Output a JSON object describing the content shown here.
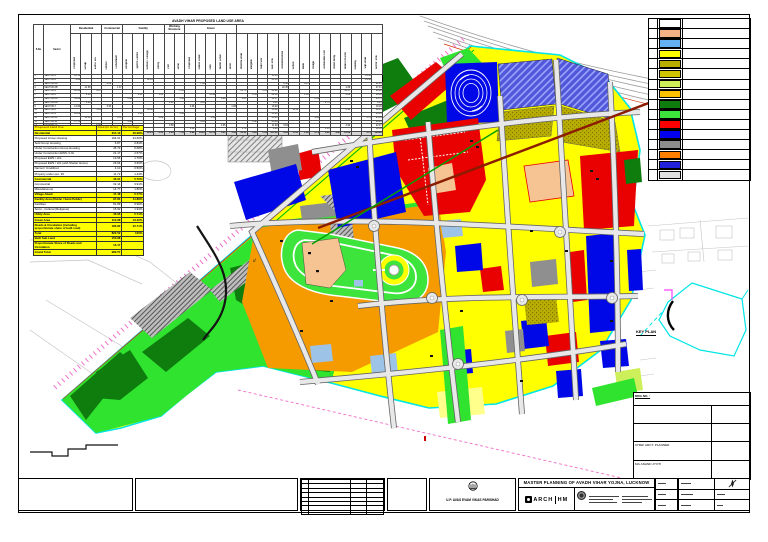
{
  "top_table": {
    "title": "AVADH VIHAR PROPOSED LAND USE AREA",
    "corner_headers": [
      "S.No",
      "Sector"
    ],
    "groups": [
      {
        "label": "Residential",
        "span": 3
      },
      {
        "label": "Commercial",
        "span": 2
      },
      {
        "label": "Facility",
        "span": 4
      },
      {
        "label": "Working Structure",
        "span": 2
      },
      {
        "label": "Green",
        "span": 5
      },
      {
        "label": "",
        "span": 14
      }
    ],
    "columns": [
      "Proposed",
      "Group",
      "EWS / LIG",
      "Offices",
      "Convenient",
      "Hospital",
      "Sports Centre",
      "School / College",
      "Utility",
      "Plot",
      "Road",
      "Proposed",
      "Public Green",
      "Park",
      "Buffer Green",
      "River",
      "Internal Road",
      "Marginal",
      "Built Site",
      "Sub Total",
      "Unconstructed",
      "School",
      "Bank",
      "Village",
      "Achievable Plot",
      "Water Body",
      "Share Pro-rata",
      "Railway",
      "Slip Road",
      "Sector Total"
    ],
    "rows": [
      [
        "1",
        "SECTOR-1",
        "10.56",
        "",
        "",
        "",
        "",
        "",
        "",
        "",
        "",
        "",
        "",
        "",
        "",
        "",
        "",
        "",
        "",
        "",
        "",
        "10.56",
        "",
        "",
        "",
        "",
        "",
        "",
        "",
        "",
        "10.56"
      ],
      [
        "2",
        "SECTOR-2",
        "9.34",
        "",
        "",
        "",
        "",
        "",
        "",
        "12.16",
        "",
        "",
        "",
        "",
        "",
        "",
        "",
        "",
        "",
        "",
        "",
        "21.50",
        "",
        "",
        "",
        "",
        "",
        "",
        "",
        "",
        "21.50"
      ],
      [
        "3",
        "SECTOR-3A",
        "",
        "",
        "",
        "0.62",
        "",
        "",
        "",
        "",
        "",
        "",
        "",
        "",
        "7.84",
        "",
        "",
        "",
        "",
        "",
        "",
        "",
        "8.46",
        "",
        "4.15",
        "",
        "",
        "",
        "",
        "",
        "",
        "12.61"
      ],
      [
        "4",
        "SECTOR-3B",
        "",
        "21.08",
        "",
        "",
        "1.37",
        "",
        "",
        "",
        "",
        "",
        "",
        "",
        "",
        "",
        "",
        "",
        "",
        "",
        "",
        "",
        "22.45",
        "",
        "",
        "",
        "",
        "",
        "4.86",
        "",
        "",
        "27.31"
      ],
      [
        "5",
        "SECTOR-4",
        "18.60",
        "",
        "4.87",
        "",
        "",
        "",
        "",
        "",
        "",
        "",
        "2.66",
        "",
        "",
        "",
        "",
        "",
        "21.73",
        "",
        "2.05",
        "49.91",
        "",
        "",
        "",
        "",
        "",
        "",
        "14.57",
        "",
        "",
        "64.48"
      ],
      [
        "6",
        "SECTOR-5",
        "",
        "6.54",
        "",
        "",
        "",
        "",
        "0.51",
        "",
        "1.35",
        "",
        "",
        "",
        "",
        "15.40",
        "",
        "",
        "",
        "0.34",
        "",
        "24.14",
        "",
        "",
        "1.38",
        "",
        "",
        "",
        "2.82",
        "",
        "",
        "26.96"
      ],
      [
        "7",
        "SECTOR-6A",
        "34.62",
        "",
        "",
        "",
        "",
        "2.93",
        "",
        "",
        "",
        "",
        "1.18",
        "",
        "",
        "",
        "0.99",
        "",
        "1.85",
        "",
        "",
        "41.57",
        "",
        "",
        "",
        "2.19",
        "",
        "",
        "",
        "",
        "",
        "43.76"
      ],
      [
        "8",
        "SECTOR-6B",
        "",
        "3.08",
        "",
        "",
        "",
        "",
        "",
        "",
        "",
        "1.41",
        "",
        "",
        "3.95",
        "",
        "",
        "",
        "",
        "",
        "",
        "8.44",
        "",
        "",
        "",
        "",
        "0.75",
        "",
        "",
        "",
        "",
        "9.19"
      ],
      [
        "9",
        "SECTOR-7",
        "14.82",
        "",
        "",
        "0.93",
        "",
        "",
        "",
        "",
        "",
        "",
        "",
        "2.46",
        "",
        "",
        "",
        "1.08",
        "",
        "",
        "",
        "19.29",
        "",
        "",
        "",
        "",
        "",
        "",
        "",
        "",
        "",
        "19.29"
      ],
      [
        "10",
        "SECTOR-8",
        "",
        "",
        "5.61",
        "",
        "",
        "",
        "",
        "10.08",
        "",
        "",
        "",
        "",
        "",
        "",
        "",
        "",
        "",
        "",
        "",
        "15.69",
        "",
        "13.50",
        "",
        "",
        "",
        "",
        "0.96",
        "",
        "",
        "30.15"
      ],
      [
        "11",
        "SECTOR-9",
        "28.89",
        "",
        "",
        "",
        "",
        "",
        "1.46",
        "",
        "",
        "",
        "3.30",
        "",
        "",
        "",
        "",
        "",
        "",
        "",
        "",
        "33.65",
        "",
        "",
        "",
        "",
        "",
        "",
        "",
        "",
        "",
        "33.65"
      ],
      [
        "12",
        "SECTOR-10",
        "",
        "12.10",
        "",
        "",
        "0.71",
        "",
        "",
        "",
        "2.09",
        "",
        "",
        "",
        "",
        "5.36",
        "",
        "",
        "",
        "",
        "",
        "20.26",
        "",
        "",
        "",
        "4.60",
        "",
        "",
        "",
        "",
        "0.75",
        "25.61"
      ],
      [
        "13",
        "SECTOR-11",
        "17.75",
        "",
        "",
        "",
        "",
        "3.68",
        "",
        "",
        "",
        "",
        "",
        "",
        "4.44",
        "",
        "",
        "",
        "",
        "0.62",
        "",
        "26.49",
        "",
        "",
        "",
        "",
        "",
        "",
        "",
        "",
        "",
        "26.49"
      ],
      [
        "14",
        "SECTOR-12",
        "",
        "",
        "8.06",
        "",
        "",
        "",
        "",
        "",
        "",
        "0.88",
        "",
        "",
        "",
        "",
        "2.35",
        "",
        "",
        "",
        "",
        "11.29",
        "6.84",
        "",
        "",
        "",
        "",
        "",
        "3.94",
        "",
        "",
        "22.07"
      ],
      [
        "15",
        "SECTOR-13",
        "",
        "4.97",
        "",
        "",
        "",
        "",
        "",
        "",
        "",
        "",
        "",
        "1.52",
        "",
        "",
        "",
        "",
        "2.74",
        "",
        "",
        "9.23",
        "",
        "",
        "",
        "",
        "1.13",
        "",
        "",
        "",
        "",
        "10.36"
      ]
    ],
    "totals": [
      "",
      "Total",
      "134.58",
      "47.77",
      "18.54",
      "1.55",
      "2.08",
      "6.61",
      "1.97",
      "22.24",
      "3.44",
      "2.29",
      "7.14",
      "3.98",
      "16.23",
      "20.76",
      "3.34",
      "1.08",
      "26.32",
      "0.96",
      "2.05",
      "321.38",
      "6.84",
      "17.65",
      "1.38",
      "6.79",
      "1.88",
      "4.86",
      "22.29",
      "",
      "0.75",
      "383.99"
    ]
  },
  "landuse_table": {
    "headers": [
      "Proposed Land Use",
      "Area (in Acre)",
      "Percentage"
    ],
    "rows": [
      {
        "type": "h",
        "label": "Residential",
        "area": "304.19",
        "pct": "36.98%"
      },
      {
        "type": "s",
        "label": "Proposed Group Housing",
        "area": "194.61",
        "pct": "23.66%"
      },
      {
        "type": "s",
        "label": "Sold Group Housing",
        "area": "6.87",
        "pct": "0.84%"
      },
      {
        "type": "s",
        "label": "Under Construction Group Housing",
        "area": "46.73",
        "pct": "5.68%"
      },
      {
        "type": "s",
        "label": "Under Construction EWS / LIG",
        "area": "21.17",
        "pct": "2.57%"
      },
      {
        "type": "s",
        "label": "Proposed EWS / LIG",
        "area": "13.96",
        "pct": "1.70%"
      },
      {
        "type": "s",
        "label": "Proposed EWS / LIG (with Shelter Home)",
        "area": "29.64",
        "pct": "3.60%"
      },
      {
        "type": "s",
        "label": "Nazool / Unutilized",
        "area": "4.10",
        "pct": "0.50%"
      },
      {
        "type": "s",
        "label": "Property under sec. 39",
        "area": "11.72",
        "pct": "1.43%"
      },
      {
        "type": "h",
        "label": "Commercial",
        "area": "46.91",
        "pct": "5.70%"
      },
      {
        "type": "s",
        "label": "Commercial",
        "area": "32.14",
        "pct": "3.91%"
      },
      {
        "type": "s",
        "label": "Miscellaneous",
        "area": "14.77",
        "pct": "1.80%"
      },
      {
        "type": "h",
        "label": "Village Abadi",
        "area": "47.48",
        "pct": "5.77%"
      },
      {
        "type": "h",
        "label": "Facility Area (Public / Semi Public)",
        "area": "97.81",
        "pct": "11.89%"
      },
      {
        "type": "s",
        "label": "Facilities",
        "area": "81.89",
        "pct": "9.96%"
      },
      {
        "type": "s",
        "label": "Socio - Cultural (Religious)",
        "area": "15.92",
        "pct": "1.94%"
      },
      {
        "type": "h",
        "label": "Utility Area",
        "area": "46.95",
        "pct": "5.71%"
      },
      {
        "type": "h",
        "label": "Green Area",
        "area": "110.38",
        "pct": "13.42%"
      },
      {
        "type": "h",
        "label": "Roads & Circulation (including proportionate share of built road)",
        "area": "186.80",
        "pct": "22.71%"
      },
      {
        "type": "h",
        "label": "Total",
        "area": "822.52",
        "pct": "100%"
      },
      {
        "type": "h",
        "label": "Built Sub Land",
        "area": "150.88",
        "pct": ""
      },
      {
        "type": "h",
        "label": "Proportionate Share of Roads and Circulation",
        "area": "16.17",
        "pct": ""
      },
      {
        "type": "h",
        "label": "Grand Total",
        "area": "989.57",
        "pct": ""
      }
    ]
  },
  "legend": {
    "rows": [
      {
        "name": "unshaded",
        "color": "#FFFFFF",
        "pattern": "none",
        "label": ""
      },
      {
        "name": "peach",
        "color": "#F4B183",
        "pattern": "none",
        "label": ""
      },
      {
        "name": "light-blue",
        "color": "#63B1F2",
        "pattern": "none",
        "label": ""
      },
      {
        "name": "yellow",
        "color": "#FFFF00",
        "pattern": "none",
        "label": ""
      },
      {
        "name": "olive-hatch",
        "color": "#B9AE00",
        "pattern": "olive",
        "label": ""
      },
      {
        "name": "olive-hatch-2",
        "color": "#CFC400",
        "pattern": "olive2",
        "label": ""
      },
      {
        "name": "yellow-green",
        "color": "#CDF05A",
        "pattern": "none",
        "label": ""
      },
      {
        "name": "amber",
        "color": "#FFC000",
        "pattern": "none",
        "label": ""
      },
      {
        "name": "dark-green",
        "color": "#0E7D0E",
        "pattern": "none",
        "label": ""
      },
      {
        "name": "green",
        "color": "#3CE43C",
        "pattern": "none",
        "label": ""
      },
      {
        "name": "red",
        "color": "#FF0000",
        "pattern": "none",
        "label": ""
      },
      {
        "name": "blue",
        "color": "#0000EE",
        "pattern": "none",
        "label": ""
      },
      {
        "name": "gray",
        "color": "#8C8C8C",
        "pattern": "none",
        "label": ""
      },
      {
        "name": "orange",
        "color": "#FF8000",
        "pattern": "none",
        "label": ""
      },
      {
        "name": "blue-dashed",
        "color": "#2222DD",
        "pattern": "dash-blue",
        "label": ""
      },
      {
        "name": "gray-hatch",
        "color": "#E0E0E0",
        "pattern": "hatch",
        "label": ""
      }
    ]
  },
  "keyplan": {
    "title": "KEY PLAN",
    "drg_label": "DRG NO. :",
    "rows": [
      {
        "label": "",
        "value": ""
      },
      {
        "label": "",
        "value": ""
      },
      {
        "label": "CHIEF ARCT. PLANNER",
        "value": ""
      },
      {
        "label": "M/s ANAND JYOTI",
        "value": ""
      }
    ]
  },
  "titleblock": {
    "agency": "U.P. AVAS EVAM VIKAS PARISHAD",
    "firm_prefix": "ARCH",
    "firm_suffix": "HM",
    "project_title": "MASTER PLANNING OF AVADH VIHAR YOJNA, LUCKNOW",
    "revision_rows": 8
  },
  "map": {
    "labels": {
      "d_label": "d"
    },
    "palette": {
      "yellow": "#FFFF00",
      "paleYellow": "#FFFF8C",
      "yellowGreen": "#CDF05A",
      "orange": "#F59B00",
      "red": "#E90000",
      "blue": "#0008E8",
      "periwinkle": "#5157D8",
      "lightBlue": "#9DC3E6",
      "darkGreen": "#0E7D0E",
      "green": "#2FE32F",
      "parkGreen": "#3CE43C",
      "peach": "#F6C392",
      "gray": "#8F8F8F",
      "roadFill": "#E8E8E8",
      "roadEdge": "#666666",
      "cyan": "#00E5E5",
      "magenta": "#F06FC8",
      "darkRed": "#8B1C00",
      "greenLine": "#00A000",
      "boundaryRed": "#DD2200",
      "boundaryGreen": "#00BB00"
    }
  }
}
